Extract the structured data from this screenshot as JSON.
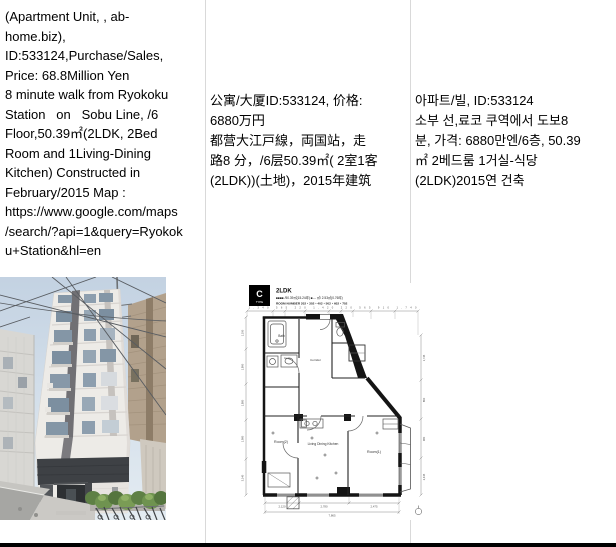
{
  "document": {
    "border_color": "#d9d9d9",
    "bottom_bar_color": "#000000",
    "columns": [
      {
        "lang": "en",
        "text": "(Apartment Unit, , ab-\nhome.biz),\nID:533124,Purchase/Sales,\nPrice: 68.8Million Yen\n8 minute walk from Ryokoku\nStation   on   Sobu Line, /6\nFloor,50.39㎡(2LDK, 2Bed\nRoom and 1Living-Dining\nKitchen) Constructed in\nFebruary/2015 Map :\nhttps://www.google.com/maps\n/search/?api=1&query=Ryokok\nu+Station&hl=en"
      },
      {
        "lang": "zh",
        "text": "公寓/大厦ID:533124, 价格:\n6880万円\n都营大江戸線，両国站，走\n路8 分，/6层50.39㎡( 2室1客\n(2LDK))(土地)，2015年建筑"
      },
      {
        "lang": "ko",
        "text": "아파트/빌, ID:533124\n소부 선,료코 쿠역에서 도보8\n분, 가격: 6880만엔/6층, 50.39\n㎡ 2베드룸 1거실-식당\n(2LDK)2015연 건축"
      }
    ]
  },
  "photo": {
    "sky_color": "#c7d5e3",
    "facade_color": "#edebe7",
    "band_color": "#3e4145",
    "foliage_color": "#6f9350",
    "road_color": "#a6a6a3"
  },
  "floorplan": {
    "type_label": "C",
    "type_sub": "TYPE",
    "layout": "2LDK",
    "area_line": "■■■■ /50.39㎡(15.24坪)  ■--- ㎡/ 2.53㎡(0.76坪)",
    "room_number_line": "ROOM NUMBER 202・302・402・502・602・702",
    "rooms": {
      "bath": "Bath",
      "corridor": "Corridor",
      "room2": "Room(2)",
      "ldk": "Living Dining Kitchen",
      "room1": "Room(1)"
    },
    "dims": {
      "top_row": "1,340  565  220  1,420  220  565  910  1,740",
      "left": [
        "1,190",
        "1,890",
        "1,880",
        "1,980",
        "3,140"
      ],
      "right": [
        "1,745",
        "860",
        "980",
        "2,445"
      ],
      "bottom": [
        "2,120",
        "2,780",
        "2,475"
      ],
      "total": "7,865"
    }
  }
}
